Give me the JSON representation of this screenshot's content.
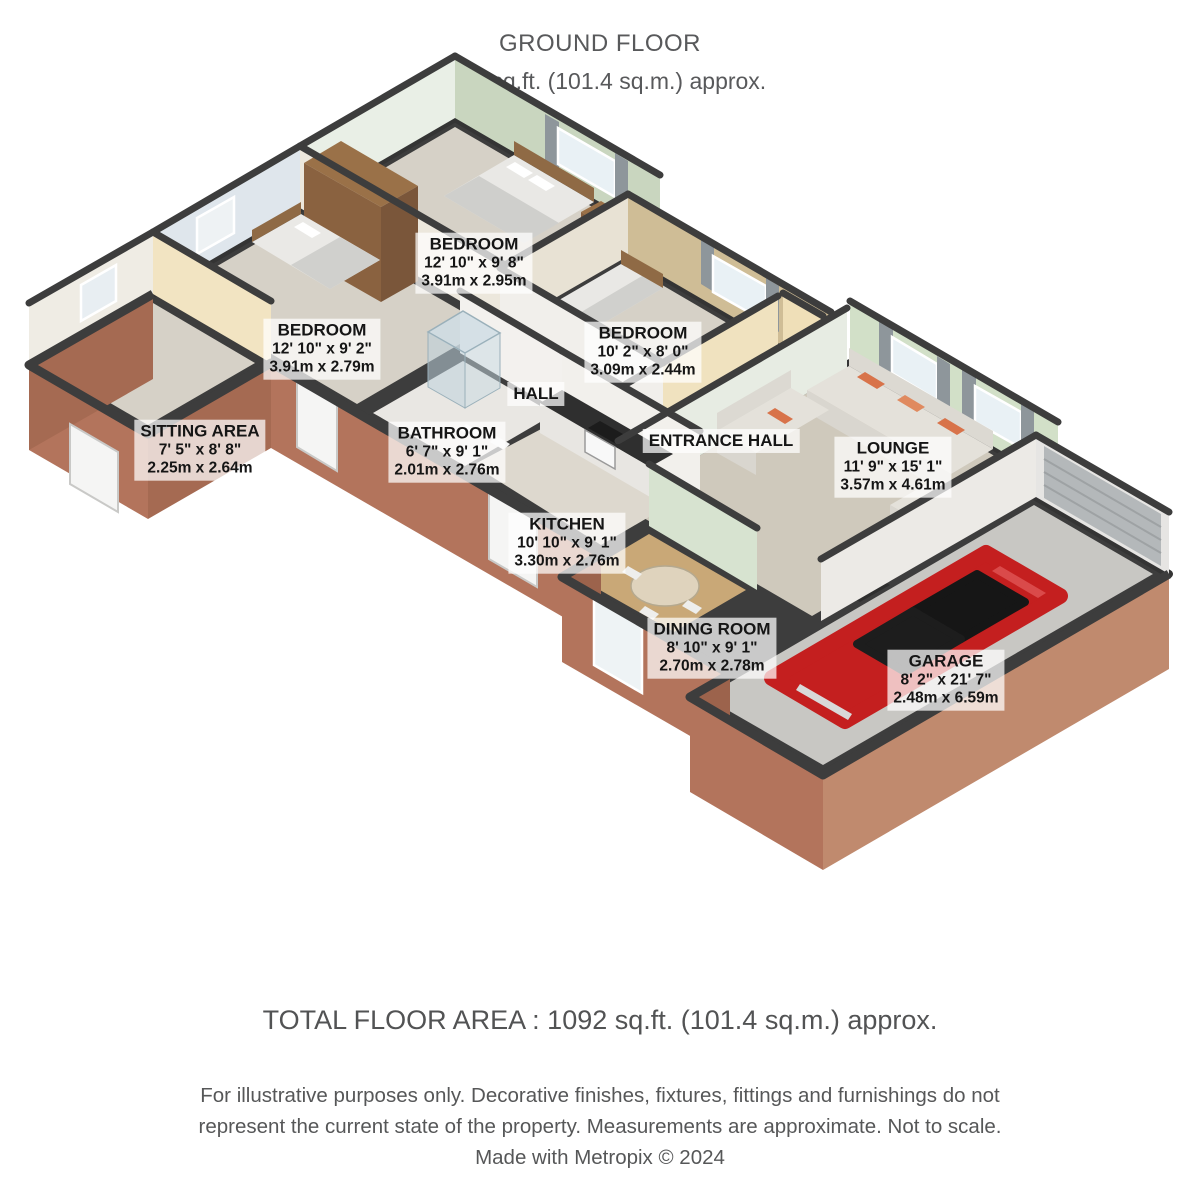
{
  "header": {
    "title": "GROUND FLOOR",
    "subtitle": "1092 sq.ft. (101.4 sq.m.) approx."
  },
  "rooms": [
    {
      "id": "bedroom-top",
      "name": "BEDROOM",
      "imperial": "12' 10\" x 9' 8\"",
      "metric": "3.91m x 2.95m"
    },
    {
      "id": "bedroom-left",
      "name": "BEDROOM",
      "imperial": "12' 10\" x 9' 2\"",
      "metric": "3.91m x 2.79m"
    },
    {
      "id": "bedroom-right",
      "name": "BEDROOM",
      "imperial": "10' 2\" x 8' 0\"",
      "metric": "3.09m x 2.44m"
    },
    {
      "id": "sitting-area",
      "name": "SITTING AREA",
      "imperial": "7' 5\" x 8' 8\"",
      "metric": "2.25m x 2.64m"
    },
    {
      "id": "hall",
      "name": "HALL"
    },
    {
      "id": "bathroom",
      "name": "BATHROOM",
      "imperial": "6' 7\" x 9' 1\"",
      "metric": "2.01m x 2.76m"
    },
    {
      "id": "entrance-hall",
      "name": "ENTRANCE HALL"
    },
    {
      "id": "lounge",
      "name": "LOUNGE",
      "imperial": "11' 9\" x 15' 1\"",
      "metric": "3.57m x 4.61m"
    },
    {
      "id": "kitchen",
      "name": "KITCHEN",
      "imperial": "10' 10\" x 9' 1\"",
      "metric": "3.30m x 2.76m"
    },
    {
      "id": "dining-room",
      "name": "DINING ROOM",
      "imperial": "8' 10\" x 9' 1\"",
      "metric": "2.70m x 2.78m"
    },
    {
      "id": "garage",
      "name": "GARAGE",
      "imperial": "8' 2\" x 21' 7\"",
      "metric": "2.48m x 6.59m"
    }
  ],
  "footer": {
    "total": "TOTAL FLOOR AREA : 1092 sq.ft. (101.4 sq.m.) approx.",
    "disclaimer_line1": "For illustrative purposes only. Decorative finishes, fixtures, fittings and furnishings do not",
    "disclaimer_line2": "represent the current state of the property. Measurements are approximate. Not to scale.",
    "credit": "Made with Metropix © 2024"
  },
  "colors": {
    "wall_dark": "#3d3d3d",
    "brick": "#ad6f58",
    "car_red": "#c41f1f",
    "label_text": "#151515",
    "heading_text": "#58595b"
  }
}
